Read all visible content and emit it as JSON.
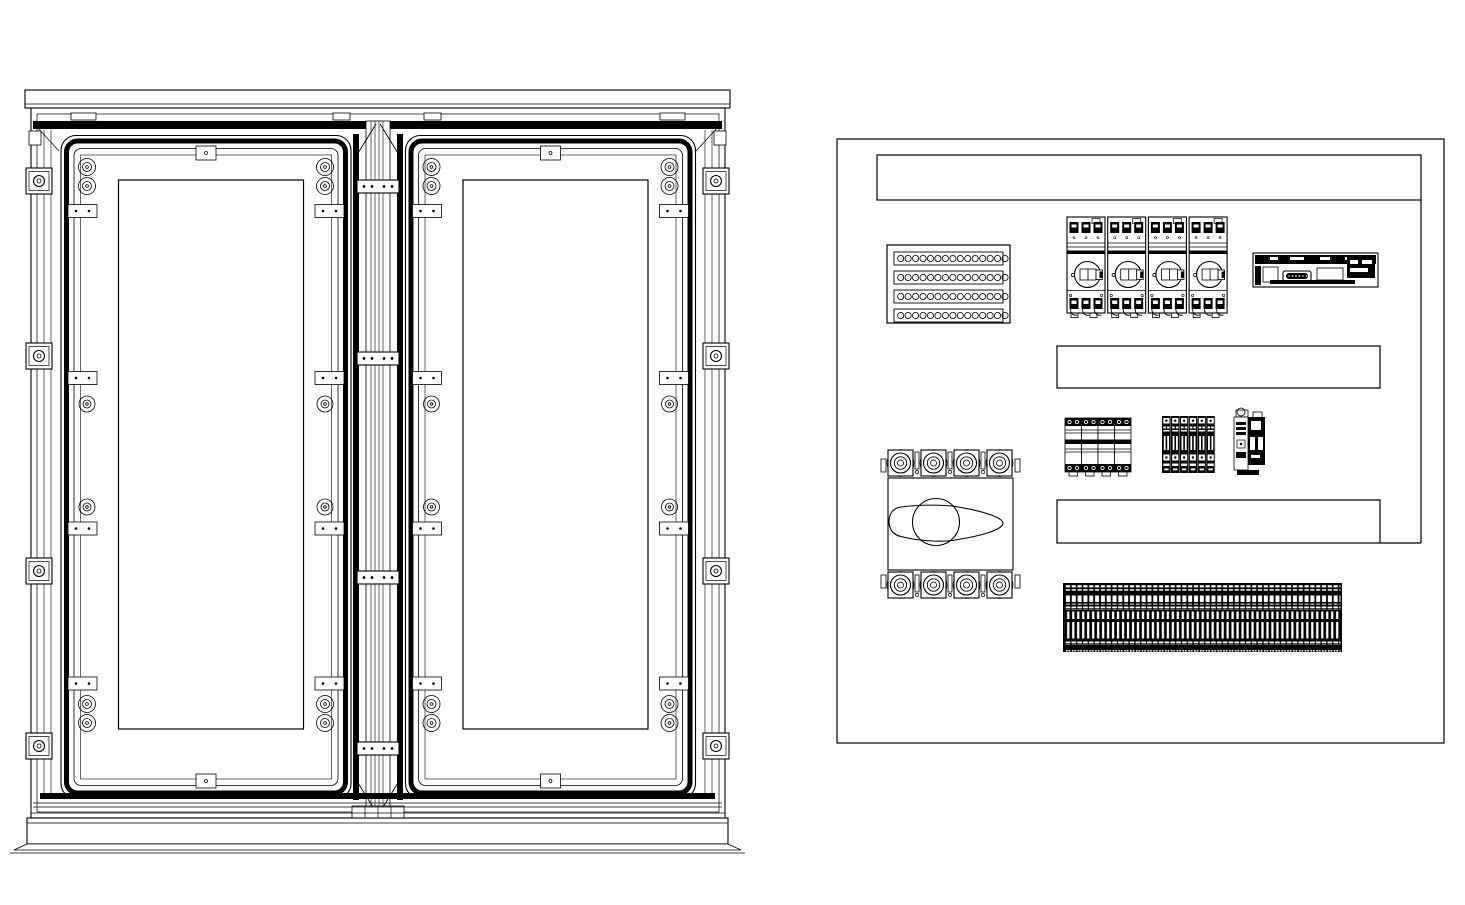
{
  "drawing": {
    "kind": "electrical-enclosure-engineering-drawing",
    "ink": "#000000",
    "paper": "#ffffff",
    "views": [
      {
        "name": "double-door-enclosure-front-view"
      },
      {
        "name": "internal-equipment-layout-view"
      }
    ]
  },
  "enclosure": {
    "doors": {
      "count": 2,
      "x0": 59.5,
      "y": 134,
      "pitch": 344.5
    },
    "hinge_plate_y": [
      180,
      352,
      571,
      742
    ],
    "side_bracket_y": [
      168,
      343,
      558,
      733
    ],
    "roof_tabs_x": [
      71,
      333,
      424,
      660
    ],
    "corner_fastener_pairs_per_door": 4,
    "mid_fasteners_per_door": 4,
    "retainer_plates_per_door": 8
  },
  "panel": {
    "outline": {
      "x": 837,
      "y": 139,
      "w": 607,
      "h": 604
    },
    "wire_ducts": [
      {
        "name": "top-wire-duct",
        "x": 877,
        "y": 155,
        "w": 544,
        "h": 45
      },
      {
        "name": "middle-wire-duct",
        "x": 1057,
        "y": 346,
        "w": 323,
        "h": 42
      },
      {
        "name": "bottom-wire-duct",
        "x": 1057,
        "y": 500,
        "w": 323,
        "h": 43
      }
    ],
    "gland_plate": {
      "x": 887,
      "y": 245,
      "w": 123,
      "h": 78,
      "rows": 4,
      "holes_per_row": 15
    },
    "breakers": {
      "count": 4,
      "poles": 3,
      "x": 1067,
      "y": 217,
      "pitch": 40.7
    },
    "controller_module": {
      "count": 1
    },
    "relay_modules": {
      "count": 4,
      "x": 1065,
      "y": 418,
      "pitch": 16.5
    },
    "mcb_modules": {
      "count": 6,
      "x": 1162,
      "y": 416,
      "pitch": 8.85
    },
    "contactor": {
      "count": 1
    },
    "disconnect_switch": {
      "poles": 4,
      "lug_x": 887,
      "lug_pitch": 33,
      "top_y": 448,
      "bottom_y": 570
    },
    "terminal_strip": {
      "x": 1063,
      "y": 583,
      "w": 279,
      "h": 69,
      "clamps": 55
    }
  }
}
